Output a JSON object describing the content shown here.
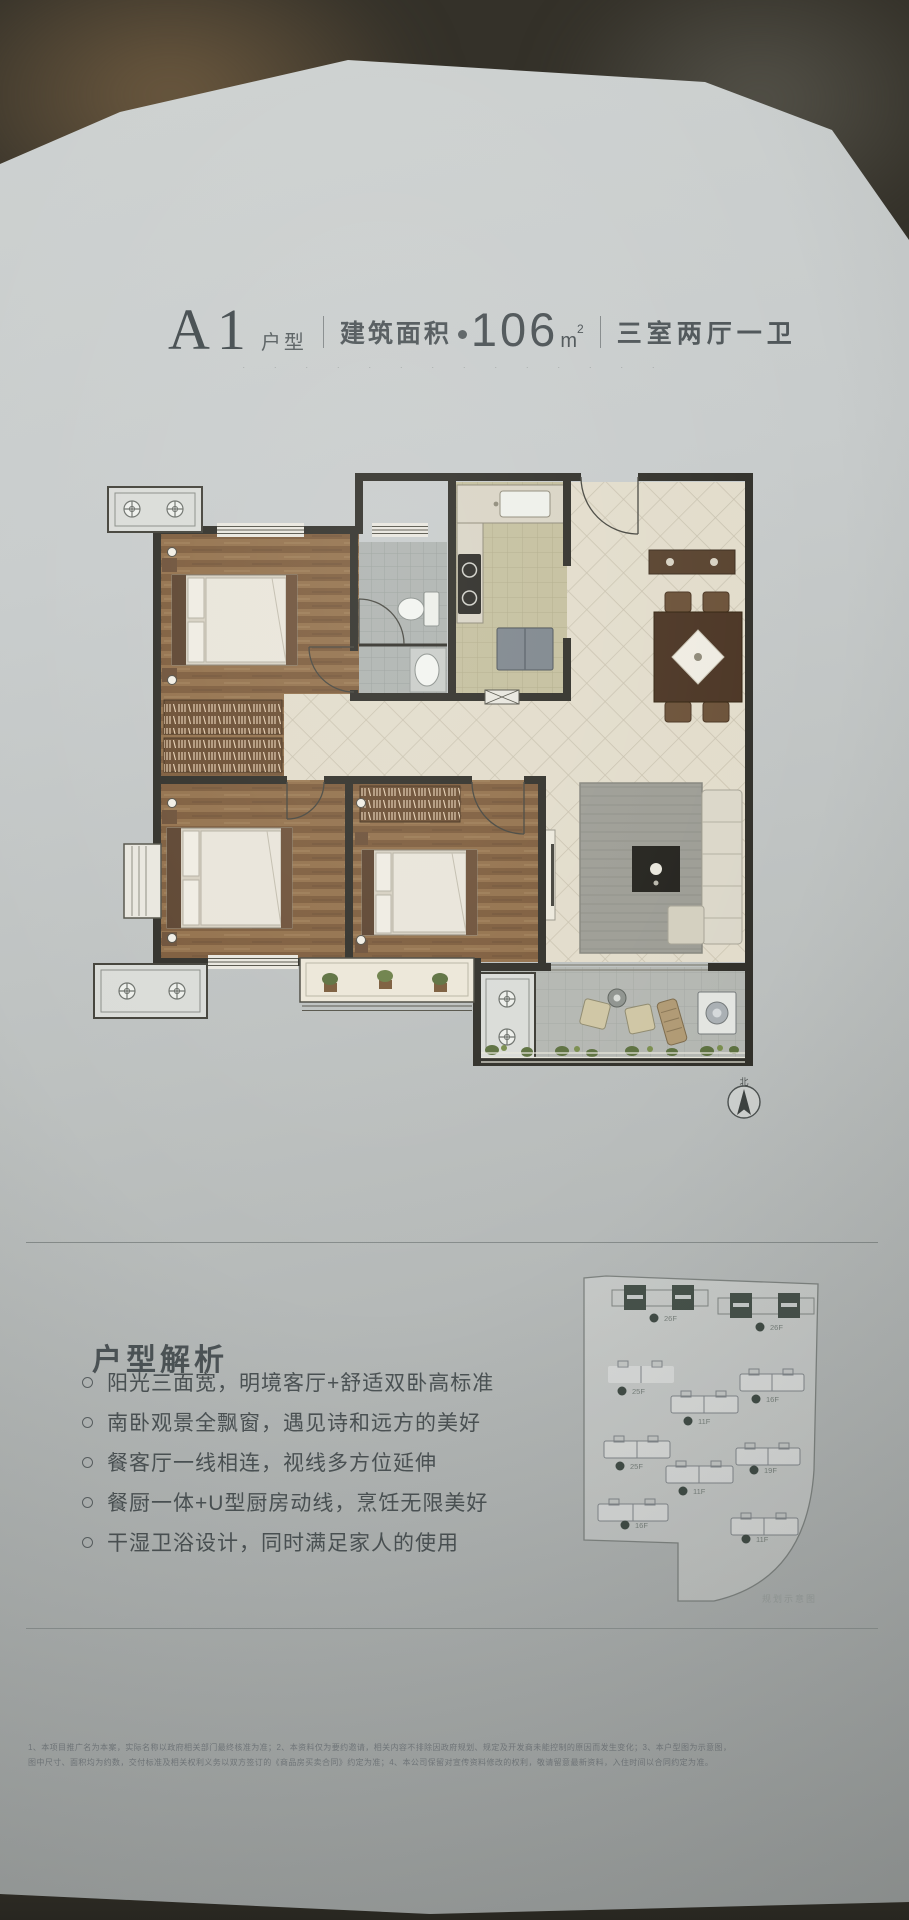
{
  "title": {
    "code": "A1",
    "code_suffix": "户型",
    "area_label": "建筑面积",
    "area_value": "106",
    "area_unit": "m",
    "area_unit_sup": "2",
    "layout": "三室两厅一卫",
    "tagline_dots": "· · · · · · · · · · · · · ·"
  },
  "floor_plan": {
    "compass_label": "北"
  },
  "analysis": {
    "heading": "户型解析",
    "bullets": [
      "阳光三面宽，明境客厅+舒适双卧高标准",
      "南卧观景全飘窗，遇见诗和远方的美好",
      "餐客厅一线相连，视线多方位延伸",
      "餐厨一体+U型厨房动线，烹饪无限美好",
      "干湿卫浴设计，同时满足家人的使用"
    ]
  },
  "site_plan": {
    "caption": "规划示意图",
    "buildings": [
      {
        "floors": "26F"
      },
      {
        "floors": "26F"
      },
      {
        "floors": "25F"
      },
      {
        "floors": "16F"
      },
      {
        "floors": "11F"
      },
      {
        "floors": "25F"
      },
      {
        "floors": "19F"
      },
      {
        "floors": "11F"
      },
      {
        "floors": "16F"
      },
      {
        "floors": "11F"
      }
    ]
  },
  "footer": {
    "disclaimer_line1": "1、本项目推广名为本案，实际名称以政府相关部门最终核准为准；2、本资料仅为要约邀请，相关内容不排除因政府规划、规定及开发商未能控制的原因而发生变化；3、本户型图为示意图，",
    "disclaimer_line2": "图中尺寸、面积均为约数，交付标准及相关权利义务以双方签订的《商品房买卖合同》约定为准；4、本公司保留对宣传资料修改的权利，敬请留意最新资料，入住时间以合同约定为准。"
  }
}
